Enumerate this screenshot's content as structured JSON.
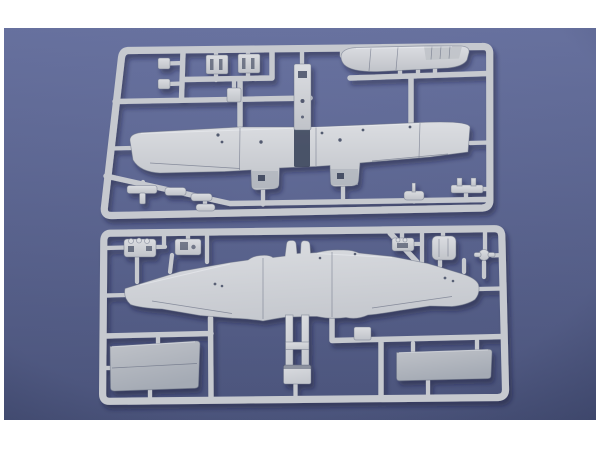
{
  "scene": {
    "type": "product-photo",
    "subject": "Two light-gray injection-molded plastic model kit sprues with twin-engine aircraft parts, lying on a blue studio backdrop inside a white photo border",
    "colors": {
      "border": "#ffffff",
      "backdrop_top": "#6a74a2",
      "backdrop_bottom": "#4d567e",
      "plastic": "#c6c9cf",
      "plastic_light": "#dbdde1",
      "plastic_mid": "#c0c3c9",
      "plastic_dark": "#a4aab4",
      "detail": "#333c55",
      "shadow": "#131b36"
    },
    "sprues": [
      {
        "id": "top-sprue",
        "parts": [
          "fuselage half with cockpit opening",
          "upper wing with two engine nacelle stubs",
          "two pilot seats",
          "cockpit floor",
          "assorted small detail parts"
        ]
      },
      {
        "id": "bottom-sprue",
        "parts": [
          "one-piece lower wing with center keel frame",
          "engine detail blocks",
          "instrument parts",
          "left hatch panel",
          "right hatch panel"
        ]
      }
    ]
  }
}
